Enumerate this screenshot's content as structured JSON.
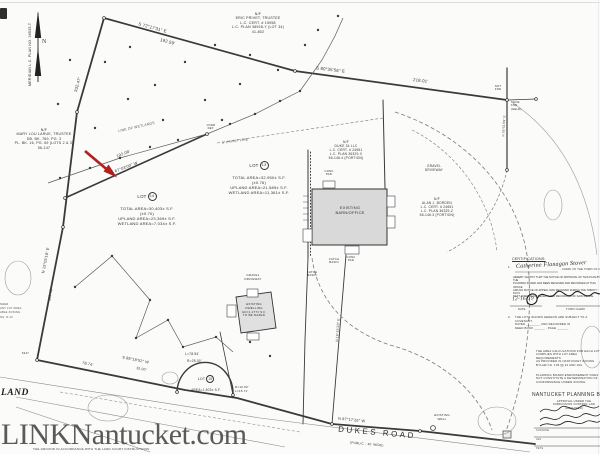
{
  "watermark": "LINKNantucket.com",
  "colors": {
    "ink": "#3a3a3a",
    "arrow_red": "#b42020",
    "building_fill": "#d9d9d9",
    "watermark_gray": "#4e4e4e"
  },
  "plan": {
    "north": {
      "meridian": "MERIDIAN L.C. PLAN NO. 36535-T",
      "letter": "N"
    },
    "owners": {
      "top": "N/F\nERIC PRIVET, TRUSTEE\nL.C. CERT. # 15958\nL.C. PLAN 38928-Y (LOT 34)\n41-802",
      "left": "N/F\nMARY LOU LARUE, TRUSTEE\nDB. BK. 769, PG. 3\nPL. BK. 16, PG. 69 (LOTS 2 & 3)\n56-147",
      "middle": "N/F\nDUKE 34 LLC\nL.C. CERT. # 24651\nL.C. PLAN 36329-X\n56-146.4 (PORTION)",
      "right": "N/F\nALAN J. BORDEN\nL.C. CERT. # 24651\nL.C. PLAN 36329-Z\n56-146.3 (PORTION)"
    },
    "lots": {
      "lot13": {
        "name": "LOT",
        "num": "13",
        "lines": "TOTAL AREA=32,950± S.F.\n(±0.76)\nUPLAND AREA=21,589± S.F.\nWETLAND AREA=11,361± S.F."
      },
      "lot14": {
        "name": "LOT",
        "num": "14",
        "lines": "TOTAL AREA=30,403± S.F.\n(±0.70)\nUPLAND AREA=23,369± S.F.\nWETLAND AREA=7,034± S.F."
      },
      "lot15": {
        "name": "LOT",
        "num": "15",
        "lines": "AREA=1,503± S.F."
      }
    },
    "bearings": {
      "b_topleft": "S 72°17'31\" E",
      "d_topleft": "192.59'",
      "b_top": "S 80°35'56\" E",
      "d_top": "218.01'",
      "d_left_upper": "332.47'",
      "b_left_lower": "N 13°05'16\" E",
      "d_left_lower": "110.49'",
      "b_diag": "S 67°03'00\" W",
      "d_diag": "192.08'",
      "b_road1": "S 88°18'52\" W",
      "d_road1": "78.74'",
      "d_road1b": "10.00'",
      "b_road2": "N 87°17'26\" W",
      "arc_l": "L=78.54'",
      "arc_r": "R=25.00'",
      "arc_small": "R=10.00'\nL=15.71'",
      "b_lotline": "N 16°43'23\" E",
      "b_fence": "N 05°51'09\" E"
    },
    "features": {
      "barn": "EXISTING\nBARN/OFFICE",
      "dwelling": "EXISTING\nDWELLING\nGD=1,177± S.F.\nTO BE RAZED",
      "gravel1": "GRAVEL\nDRIVEWAY",
      "gravel2": "GRAVEL\nDRIVEWAY",
      "well": "EXISTING\nWELL",
      "catch1": "CATCH\nBASIN",
      "catch2": "CATCH\nBASIN",
      "conc1": "CONC\nPAD",
      "conc2": "CONC\nPAD",
      "wetlands": "LINE OF WETLANDS",
      "privet": "5' PRIVET LINE",
      "notfnd": "NOT\nFND",
      "shoe": "SHOE\nFND\n(HELD)",
      "pt": "5447",
      "overdet": "OVER\nDET."
    },
    "road": {
      "name": "DUKES ROAD",
      "sub": "(PUBLIC - 40' WIDE)"
    },
    "fragments": {
      "land": "LAND",
      "zoning": "NDER\nANT LOT AREA\nABLE ZONING\nNG: R-10",
      "ground": "THE GROUND IN ACCORDANCE WITH THE LAND COURT INSTRUCTIONS."
    },
    "certifications": {
      "heading": "CERTIFICATIONS:",
      "item1_no": "1.",
      "clerk_name": "Catherine Flanagan Stover",
      "item1_line1": ", CLERK OF THE TOWN OF NANTUCKET,",
      "item1_text": "HEREBY CERTIFY THAT THE NOTICE OF APPROVAL OF THIS PLAN BY THE\nPLANNING BOARD HAS BEEN RECEIVED AND RECORDED AT THIS OFFICE\nAND NO NOTICE OF APPEAL WAS RECEIVED DURING THE TWENTY DAYS\nNEXT AFTER SUCH RECEIPT AND RECORDING OF SAID NOTICE.",
      "date_value": "12-16-19",
      "date_label": "DATE",
      "clerk_label": "TOWN CLERK",
      "item2_no": "2.",
      "item2_text": "THE LOTS SHOWN HEREON ARE SUBJECT TO A COVENANT,\nDATED ________ AND RECORDED IN\nDEED BOOK ______ , PAGE ______ .",
      "area_note": "THE AREA CALCULATIONS FOR EACH LOT\nCOMPLIES WITH LOT AREA REQUIREMENTS\nAS PROVIDED IN NANTUCKET ZONING\nBYLAW CH. 139 §§ 24 AND 16A.",
      "endorse_note": "PLANNING BOARD ENDORSEMENT DOES\nNOT CONSTITUTE A DETERMINATION OF\nCONFORMANCE UNDER ZONING.",
      "board_heading": "NANTUCKET PLANNING BOARD",
      "board_sub": "APPROVAL UNDER THE\nSUBDIVISION CONTROL LAW\n(REQUIRED)",
      "sig1": "SUZANNE",
      "sig2": "JEN",
      "sig3": "PETE"
    }
  }
}
